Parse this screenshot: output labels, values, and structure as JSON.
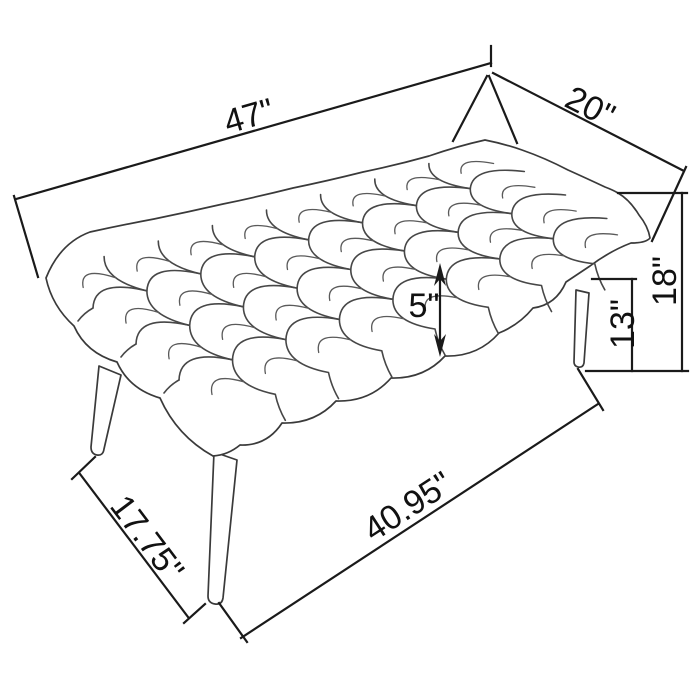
{
  "figure": {
    "subject": "Tufted upholstered bench — technical line drawing with dimensions",
    "background_color": "#ffffff",
    "artwork_line_color": "#3a3a3a",
    "dimension_line_color": "#1a1a1a",
    "text_color": "#111111"
  },
  "dimensions": {
    "top_length": "47\"",
    "top_depth": "20\"",
    "overall_height": "18\"",
    "underseat_height": "13\"",
    "cushion_thickness": "5\"",
    "base_depth": "17.75\"",
    "base_length": "40.95\""
  }
}
